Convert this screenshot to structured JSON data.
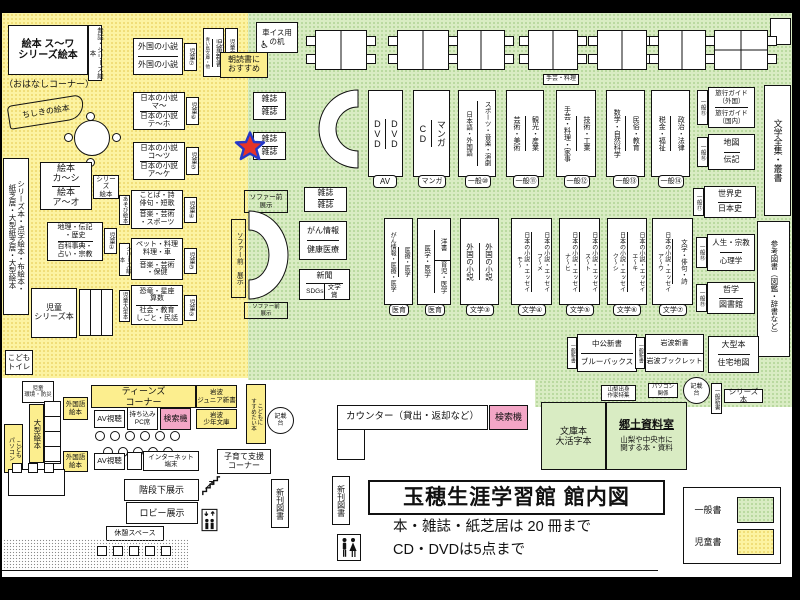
{
  "kids": {
    "su_wa": {
      "text": "絵本 ス～ワ\nシリーズ絵本",
      "tab": "昔話・シリーズ絵本",
      "note": "（おはなしコーナー）"
    },
    "chishiki": "ちしきの絵本",
    "left_strip": "シリーズ本・点字絵本・布絵本・\n紙芝居・大型紙芝居・大型絵本",
    "foreign": {
      "c1": "外国の小説",
      "c2": "外国の小説",
      "tab": "児童⑦"
    },
    "jp_ma": {
      "c1": "日本の小説\nマ～",
      "c2": "日本の小説\nテ～ホ",
      "tab": "児童⑥"
    },
    "jp_ko": {
      "c1": "日本の小説\nコ～ツ",
      "c2": "日本の小説\nア～ケ",
      "tab": "児童⑤"
    },
    "kotoba": {
      "c1": "ことば・詩\n俳句・短歌",
      "c2": "音楽・芸術\n・スポーツ",
      "tab_l": "あそび絵本",
      "tab_r": "児童④"
    },
    "pet": {
      "c1": "ペット・料理\n料理・車",
      "c2": "音楽・芸術\n・保健",
      "tab_l": "シリーズ絵本",
      "tab_r": "児童③"
    },
    "dino": {
      "c1": "恐竜・星座\n算数",
      "c2": "社会・教育\nしごと・民話",
      "tab_l": "児童大型本",
      "tab_r": "児童②"
    },
    "ehon_ka": {
      "c1": "絵本\nカ～シ",
      "c2": "絵本\nア～オ",
      "tab": "シリーズ\n絵本"
    },
    "geo": {
      "c1": "地理・伝記\n・歴史",
      "c2": "百科事典・\n占い・宗教",
      "tab": "児童①"
    },
    "series_bon": "児童\nシリーズ本",
    "shinsho": {
      "sub": "青い鳥文庫・他",
      "main": "児童新書",
      "side": "児童文庫"
    },
    "asadoku": "朝読書に\nおすすめ",
    "toilet": "こども\nトイレ",
    "kankyo": "児童\n環境・防災",
    "ogata": "大型絵本",
    "pc": "こども\nパソコン"
  },
  "top": {
    "wheelchair_desk": "車イス用\nの机",
    "mag": "雑誌",
    "shugei_note": "手芸・料理",
    "row1": {
      "p1": {
        "a": "DVD",
        "b": "DVD",
        "label": "AV"
      },
      "p2": {
        "a": "CD",
        "b": "マンガ",
        "label": "マンガ"
      },
      "p3": {
        "a": "日本語・外国語",
        "b": "スポーツ・音楽・演劇",
        "label": "一般⑩"
      },
      "p4": {
        "a": "芸術・美術",
        "b": "観光・産業",
        "label": "一般⑪"
      },
      "p5": {
        "a": "手芸・料理・家事",
        "b": "技術・工業",
        "label": "一般⑫"
      },
      "p6": {
        "a": "数学・自然科学",
        "b": "民俗・教育",
        "label": "一般⑬"
      },
      "p7": {
        "a": "税金・福祉",
        "b": "政治・法律",
        "label": "一般⑭"
      }
    },
    "right": {
      "travel": {
        "c1": "旅行ガイド\n（外国）",
        "c2": "旅行ガイド\n（国内）",
        "tab": "一般⑮"
      },
      "map": {
        "c1": "地図",
        "c2": "伝記",
        "tab": "一般⑯"
      },
      "hist": {
        "c1": "世界史",
        "c2": "日本史",
        "tab": "一般⑰"
      },
      "life": {
        "c1": "人生・宗教",
        "c2": "心理学",
        "tab": "一般⑱"
      },
      "phil": {
        "c1": "哲学",
        "c2": "図書館",
        "tab": "一般⑲"
      }
    },
    "strip_bungaku": "文学全集・叢書",
    "strip_sanko": "参考図書（図鑑・辞書など）"
  },
  "mid": {
    "sofa_label": "ソファー前\n展示",
    "sofa_v": "ソファー前 展示",
    "gan": {
      "c1": "がん情報",
      "c2": "健康医療"
    },
    "news": {
      "top": "新聞",
      "b1": "SDGs",
      "b2": "文学賞"
    },
    "row2": {
      "m1": {
        "a": "がん情報・医療・医学",
        "b": "医療・医学",
        "label": "医育"
      },
      "m2": {
        "a": "医学・医学",
        "b_top": "洋書",
        "b_bottom": "育児・医学",
        "label": "医育"
      },
      "m3": {
        "a": "外国の小説",
        "b": "外国の小説",
        "label": "文学③"
      },
      "m4": {
        "a": "日本の小説・エッセイ\nモ～",
        "b": "日本の小説・エッセイ\nフ～メ",
        "label": "文学④"
      },
      "m5": {
        "a": "日本の小説・エッセイ\nナ～ヒ",
        "b": "日本の小説・エッセイ\nス～ト",
        "label": "文学⑤"
      },
      "m6": {
        "a": "日本の小説・エッセイ\nク～シ",
        "b": "日本の小説・エッセイ\nエ～キ",
        "label": "文学⑥"
      },
      "m7": {
        "a": "日本の小説・エッセイ\nア～ウ",
        "b": "文学・俳句・詩",
        "label": "文学⑦"
      }
    }
  },
  "bot": {
    "chuko": {
      "c1": "中公新書",
      "c2": "ブルーバックス",
      "tab": "一般新書"
    },
    "iwanami": {
      "c1": "岩波新書",
      "c2": "岩波ブックレット",
      "tab": "一般新書"
    },
    "ogata_hon": {
      "c1": "大型本",
      "c2": "住宅地図"
    },
    "yamanashi": "山梨出身\n作家特集",
    "pc_kankei": "パソコン\n関係",
    "kisaidai": "記載\n台",
    "ippan_shinsho": "一般新書",
    "series": "シリーズ本",
    "bunko": "文庫本\n大活字本",
    "kyodo": {
      "title": "郷土資料室",
      "desc": "山梨や中央市に\n関する本・資料"
    },
    "counter": "カウンター（貸出・返却など）",
    "kensaku": "検索機",
    "susume": "こどもに\nすすめたい本"
  },
  "teens": {
    "header": "ティーンズ\nコーナー",
    "gaikokugo": "外国語\n絵本",
    "av": "AV視聴",
    "pc_seat": "持ち込み\nPC席",
    "kensaku": "検索機",
    "iw_junior": "岩波\nジュニア新書",
    "iw_shonen": "岩波\n少年文庫",
    "internet": "インターネット\n端末",
    "kosodate": "子育て支援\nコーナー"
  },
  "fac": {
    "kaidan": "階段下展示",
    "lobby": "ロビー展示",
    "kyukei": "休憩スペース",
    "shinkan": "新刊図書"
  },
  "title": {
    "main": "玉穂生涯学習館 館内図",
    "rule1": "本・雑誌・紙芝居は 20 冊まで",
    "rule2": "CD・DVDは5点まで"
  },
  "legend": {
    "general": "一般書",
    "children": "児童書"
  },
  "colors": {
    "children_area": "#fcf3a2",
    "general_area": "#d9ecc3",
    "search_machine": "#f3a6c6",
    "star_fill": "#e63329",
    "star_stroke": "#2438c8"
  }
}
